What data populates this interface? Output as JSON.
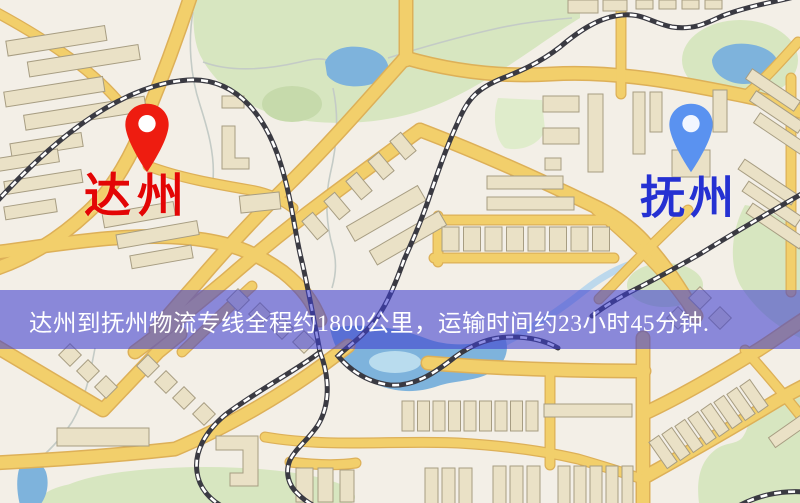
{
  "map": {
    "origin_marker": {
      "label": "达州",
      "pin_color": "#ee1c10",
      "label_color": "#e30505",
      "pin_icon": "red-map-pin"
    },
    "destination_marker": {
      "label": "抚州",
      "pin_color": "#5a92f0",
      "label_color": "#2531d2",
      "pin_icon": "blue-map-pin"
    },
    "banner": {
      "text": "达州到抚州物流专线全程约1800公里，运输时间约23小时45分钟.",
      "distance_text": "约1800公里",
      "duration_text": "约23小时45分钟",
      "background_color": "#3e3ece",
      "text_color": "#ffffff"
    },
    "legend_colors": {
      "road": "#f2cf6b",
      "road_casing": "#ddb058",
      "railway": "#3a3a42",
      "water": "#7eb3dc",
      "park": "#d7e6c0",
      "building": "#eae1c6",
      "map_background": "#f3efe7"
    }
  }
}
